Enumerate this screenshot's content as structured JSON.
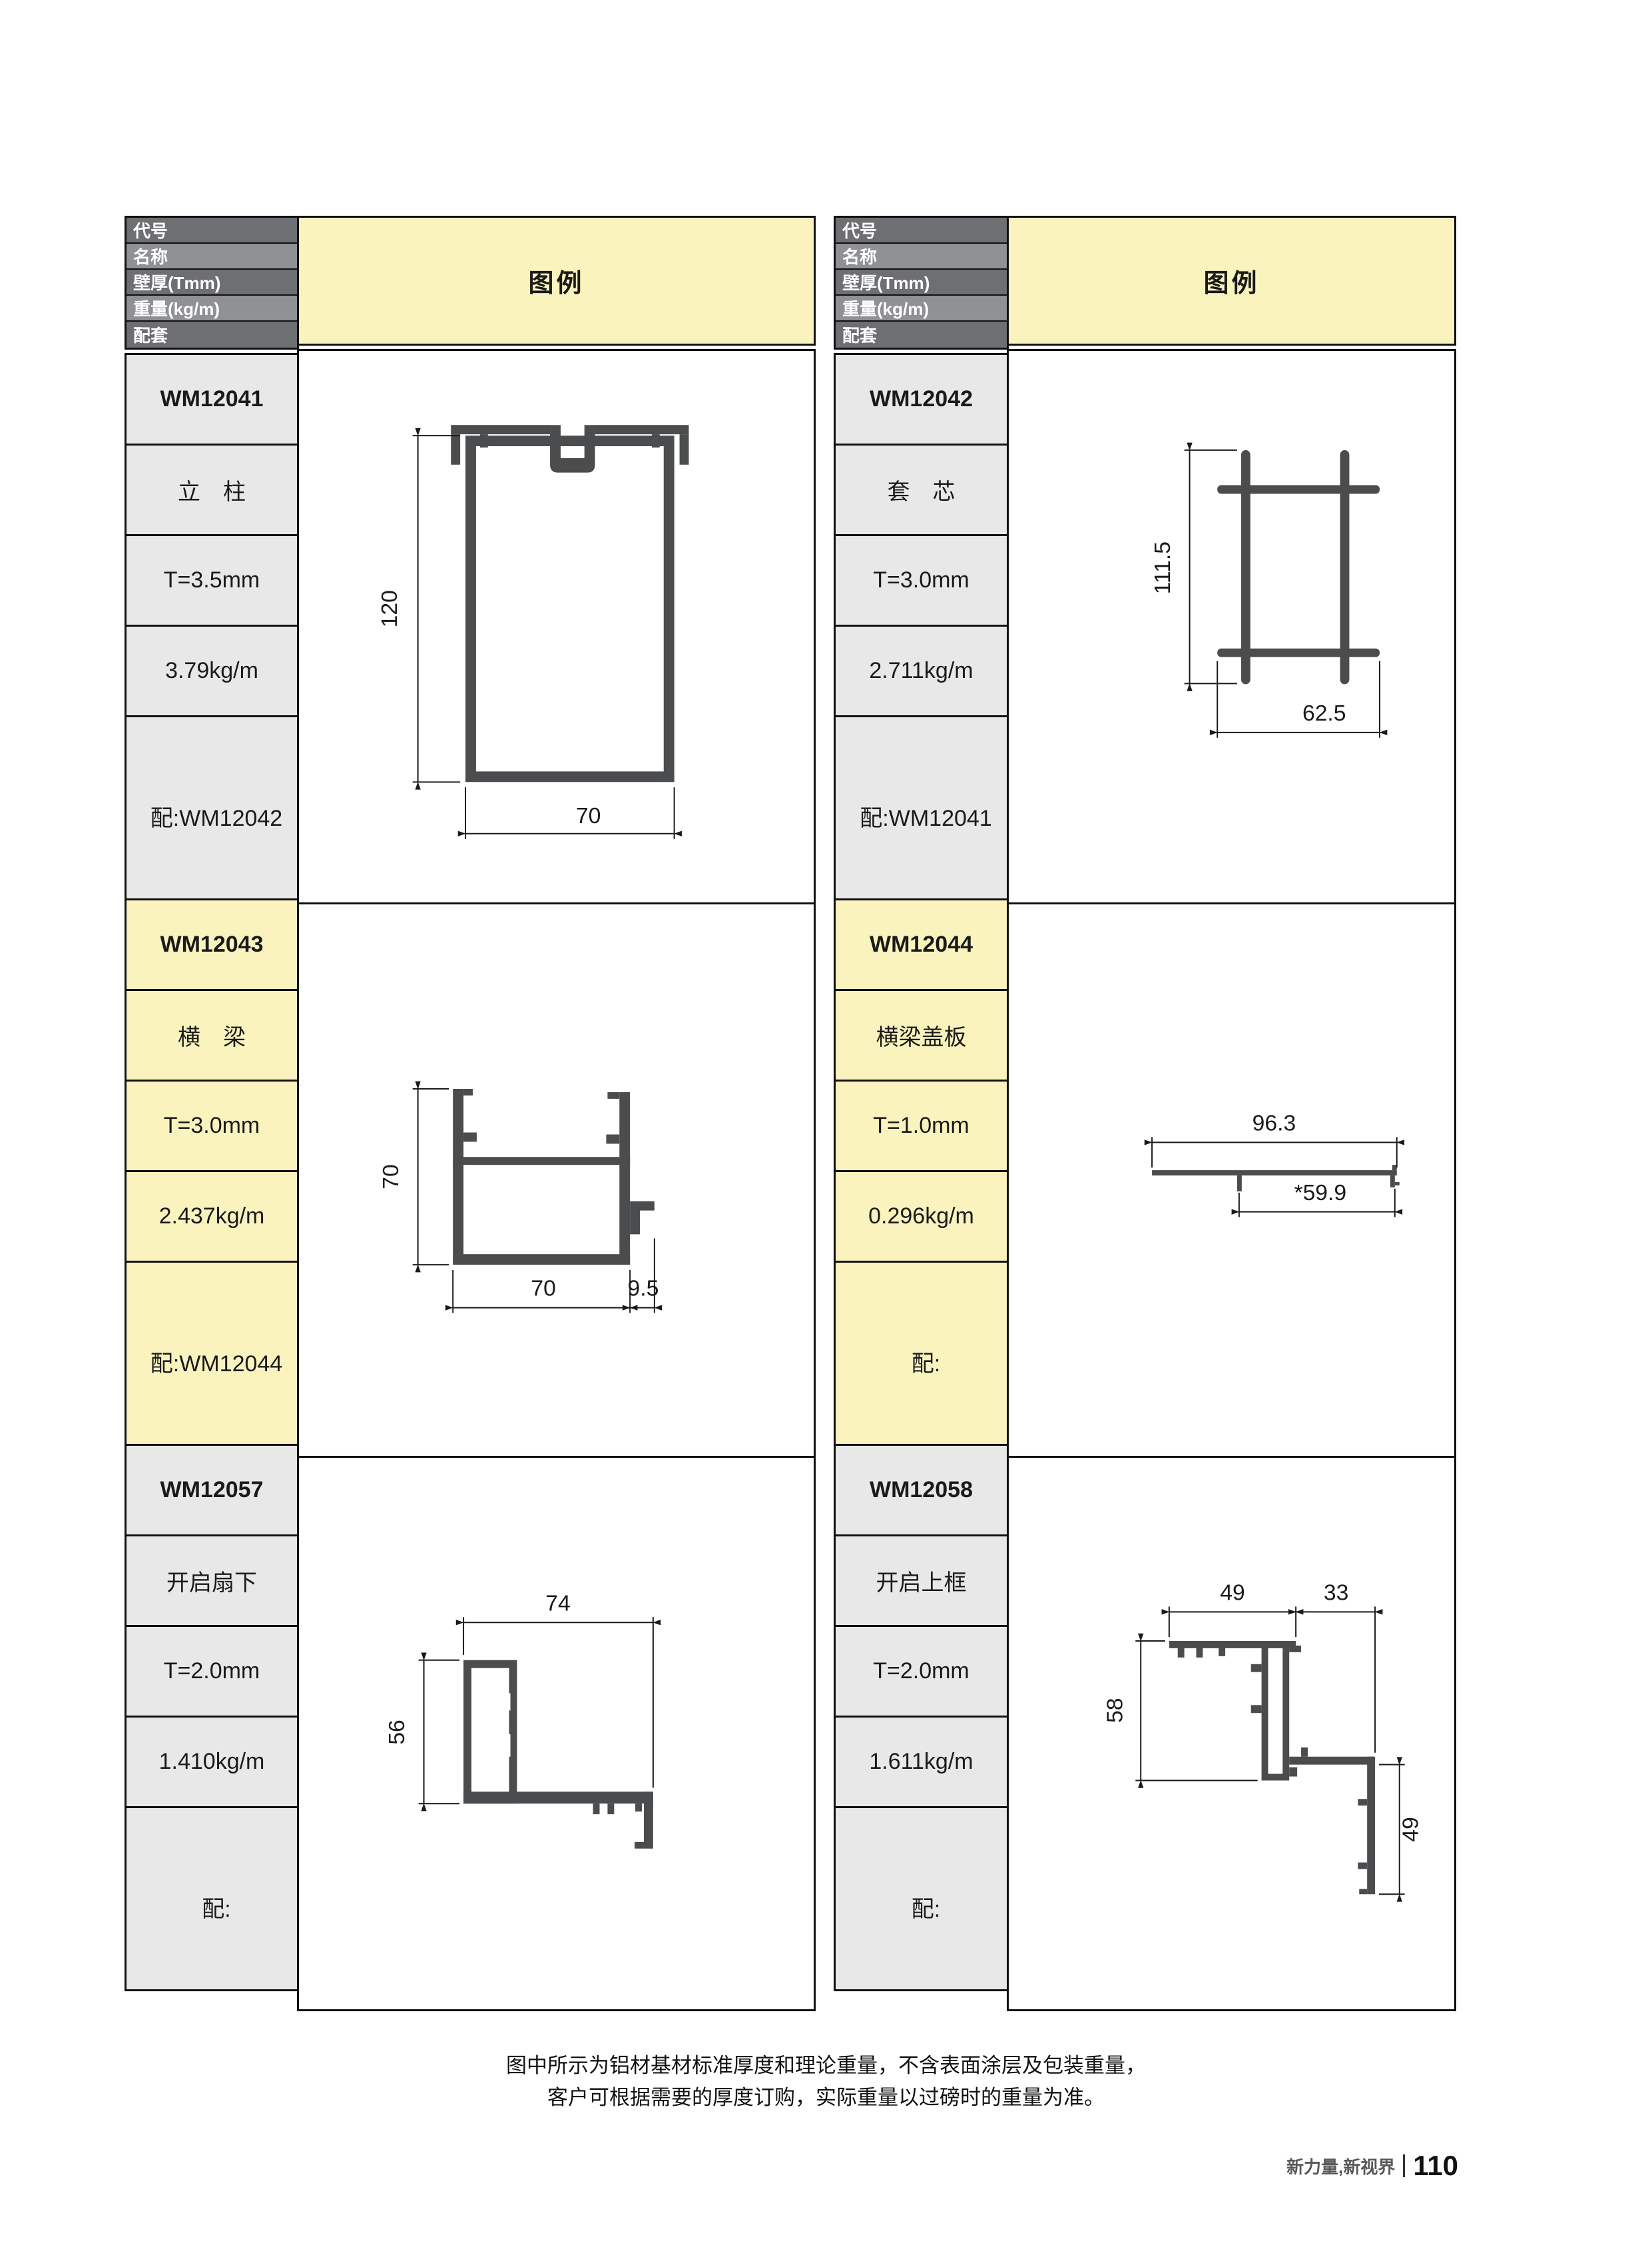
{
  "table": {
    "header_labels": [
      "代号",
      "名称",
      "壁厚(Tmm)",
      "重量(kg/m)",
      "配套"
    ],
    "legend_label": "图例"
  },
  "profiles": [
    {
      "code": "WM12041",
      "name": "立　柱",
      "thickness": "T=3.5mm",
      "weight": "3.79kg/m",
      "mate": "配:WM12042",
      "dims": {
        "height": "120",
        "width": "70"
      }
    },
    {
      "code": "WM12042",
      "name": "套　芯",
      "thickness": "T=3.0mm",
      "weight": "2.711kg/m",
      "mate": "配:WM12041",
      "dims": {
        "height": "111.5",
        "width": "62.5"
      }
    },
    {
      "code": "WM12043",
      "name": "横　梁",
      "thickness": "T=3.0mm",
      "weight": "2.437kg/m",
      "mate": "配:WM12044",
      "dims": {
        "height": "70",
        "width": "70",
        "foot": "9.5"
      }
    },
    {
      "code": "WM12044",
      "name": "横梁盖板",
      "thickness": "T=1.0mm",
      "weight": "0.296kg/m",
      "mate": "配:",
      "dims": {
        "top": "96.3",
        "bottom": "*59.9"
      }
    },
    {
      "code": "WM12057",
      "name": "开启扇下",
      "thickness": "T=2.0mm",
      "weight": "1.410kg/m",
      "mate": "配:",
      "dims": {
        "width": "74",
        "height": "56"
      }
    },
    {
      "code": "WM12058",
      "name": "开启上框",
      "thickness": "T=2.0mm",
      "weight": "1.611kg/m",
      "mate": "配:",
      "dims": {
        "top_left": "49",
        "top_right": "33",
        "left": "58",
        "right": "49"
      }
    }
  ],
  "page": {
    "note_line1": "图中所示为铝材基材标准厚度和理论重量，不含表面涂层及包装重量，",
    "note_line2": "客户可根据需要的厚度订购，实际重量以过磅时的重量为准。",
    "footer_brand": "新力量,新视界",
    "footer_page": "110"
  },
  "colors": {
    "legend_yellow": "#faf3be",
    "cell_gray": "#e8e8e9",
    "header_dark_gray": "#6e6f72",
    "header_light_gray": "#8f9194",
    "ink": "#1a1a1a",
    "profile_fill": "#4b4c4e"
  }
}
